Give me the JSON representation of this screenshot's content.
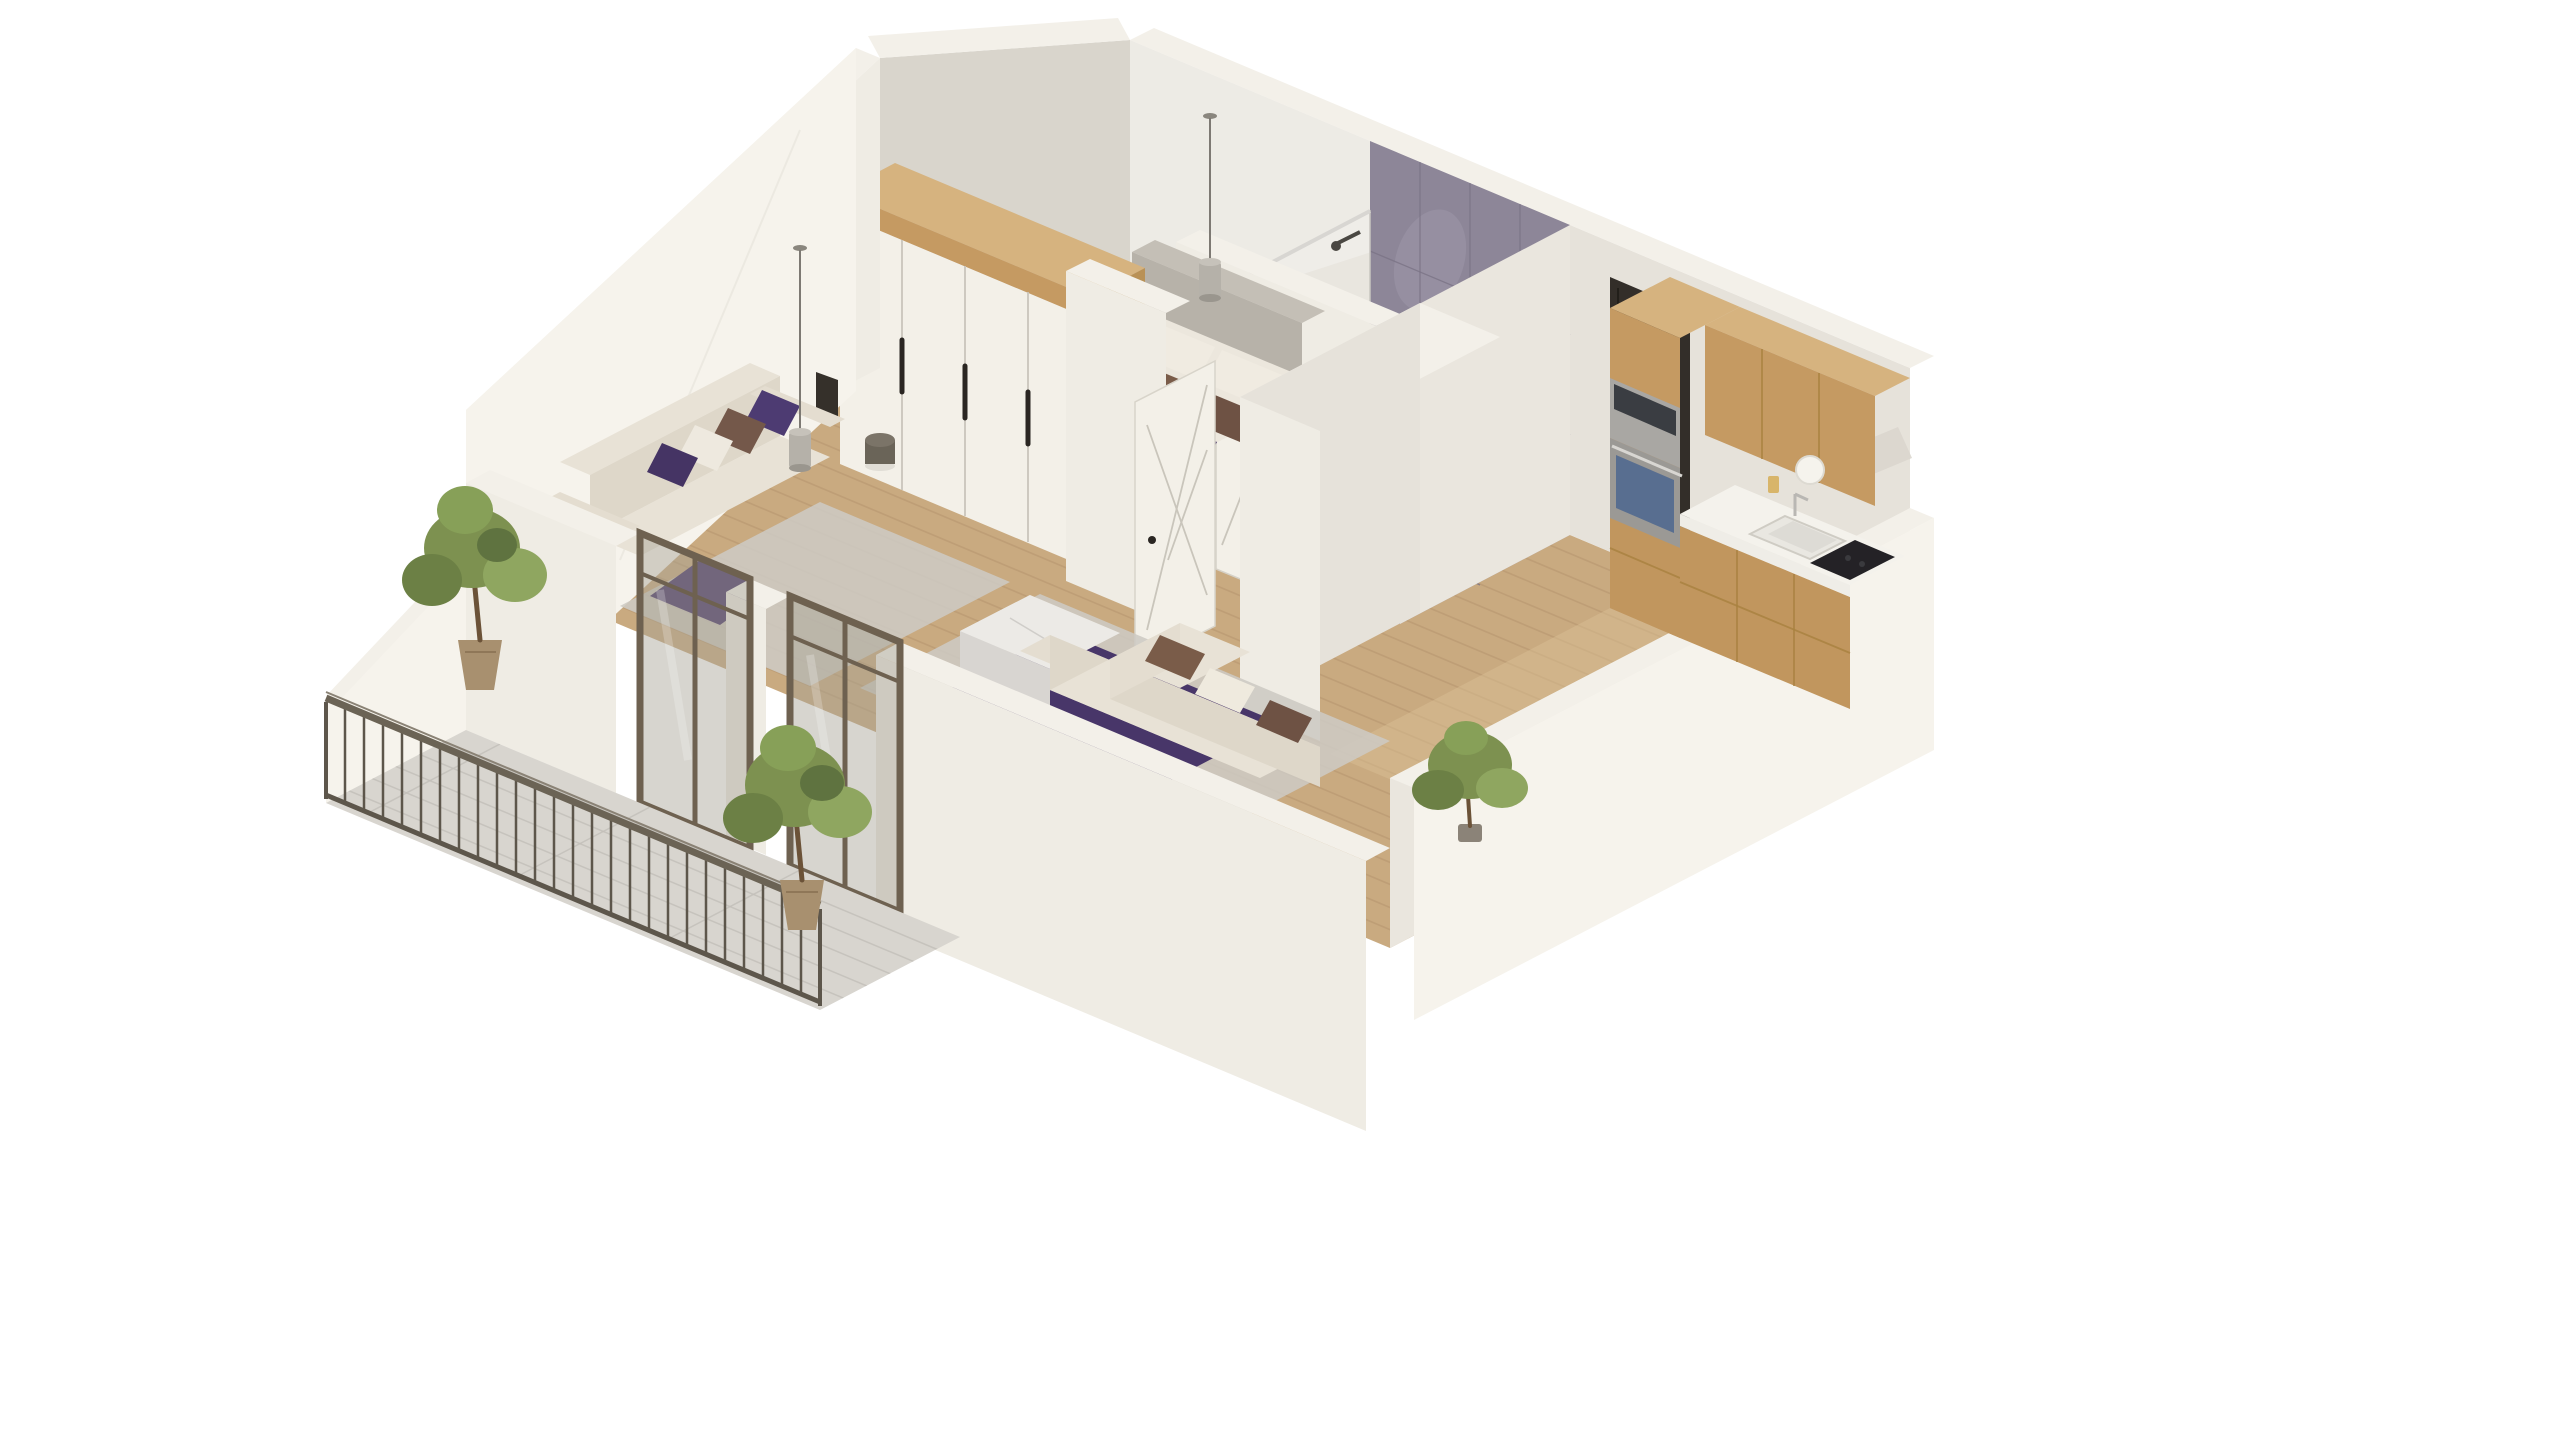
{
  "meta": {
    "description": "3D isometric architectural rendering of a one-bedroom apartment floor plan with bedroom, bathroom, kitchen, living areas and a balcony, on a white background. No visible text labels.",
    "view": "isometric cutaway from above"
  },
  "colors": {
    "page_bg": "#ffffff",
    "wall_bright": "#f3f0e9",
    "wall_face": "#efece4",
    "wall_face_bright": "#f6f3ec",
    "wall_shade": "#d9d5cc",
    "wall_soft": "#e6e2da",
    "wall_soft2": "#eae6de",
    "floor_wood": "#c9aa80",
    "floor_wood_line": "#b3926b",
    "floor_wood_light": "#dcc096",
    "balcony_floor": "#d8d5cf",
    "balcony_line": "#c3c0ba",
    "rug_gray": "#cdc9c3",
    "rug_purple": "#483669",
    "purple_mid": "#4d3b72",
    "purple_dark": "#453464",
    "brown_mid": "#7a5c49",
    "brown_dark": "#6e5244",
    "brown_soft": "#74584a",
    "sofa_cream": "#e8e2d6",
    "sofa_cream_dark": "#ded7c9",
    "sofa_cream_mid": "#e4ddd0",
    "bed_sheet": "#ece7dd",
    "bed_quilt": "#f1ede3",
    "bed_head": "#b7b2a9",
    "bed_head_top": "#c4bfb6",
    "bed_side": "#e2dcd0",
    "bed_front": "#d9d3c6",
    "wood_cab": "#c59a62",
    "wood_cab_dark": "#c1965e",
    "wood_cab_top": "#d6b37f",
    "wood_gap": "#a8813f",
    "wood_side": "#b99156",
    "counter": "#f4f2ec",
    "counter_edge": "#efede7",
    "steel": "#a9a7a3",
    "steel_dark": "#9b9995",
    "appliance_dark": "#3a3d42",
    "appliance_blue": "#51698f",
    "cooktop": "#242226",
    "door_dark": "#332e29",
    "door_white": "#f3f0e8",
    "groove": "#c9c5bb",
    "handle_dark": "#2a2622",
    "tile_marble": "#8d8698",
    "tile_line": "#7a7386",
    "tile_light": "#a39dae",
    "bath_floor": "#97909f",
    "glass": "#a7a195",
    "frame_bronze": "#6e6150",
    "glass_chrome": "#d8d6d2",
    "railing": "#5d564b",
    "rail_top": "#6b6355",
    "rail_hi": "#8a8275",
    "green1": "#7d9150",
    "green2": "#8fa660",
    "green3": "#6c8045",
    "green4": "#87a058",
    "green5": "#5f7340",
    "trunk": "#6b5238",
    "pot": "#a8906f",
    "pot_dark": "#8b8378",
    "metal_gray": "#7b7468",
    "metal_gray_dark": "#6a6458",
    "pendant": "#b5b1a9",
    "cord": "#7d7973",
    "marble_table": "#eceae6",
    "marble_side": "#d8d5d1",
    "marble_w": "#e2dfdb",
    "slot_dark": "#35302a"
  },
  "scene": {
    "rooms": [
      "bedroom",
      "bathroom",
      "hallway",
      "kitchen",
      "living-room",
      "second-room",
      "balcony"
    ],
    "objects": [
      "double-bed with white, brown and purple pillows",
      "gray upholstered headboard",
      "white wardrobe with wood top and dark handles",
      "two hanging pendant lights",
      "dark round bedside table",
      "marble tiled bathroom wall with glass shower",
      "white bathroom door with cross grooves",
      "dark entry door",
      "oak kitchen cabinets with steel oven and microwave",
      "white countertop with sink and black cooktop",
      "open white interior door with cross grooves",
      "cream corner sofa with brown pillows",
      "second sofa with purple and brown pillows",
      "gray and purple rugs",
      "white marble coffee table",
      "metal balcony railing with vertical bars",
      "two potted green trees on balcony",
      "indoor green plant",
      "wood plank flooring",
      "gray tiled balcony floor"
    ]
  }
}
